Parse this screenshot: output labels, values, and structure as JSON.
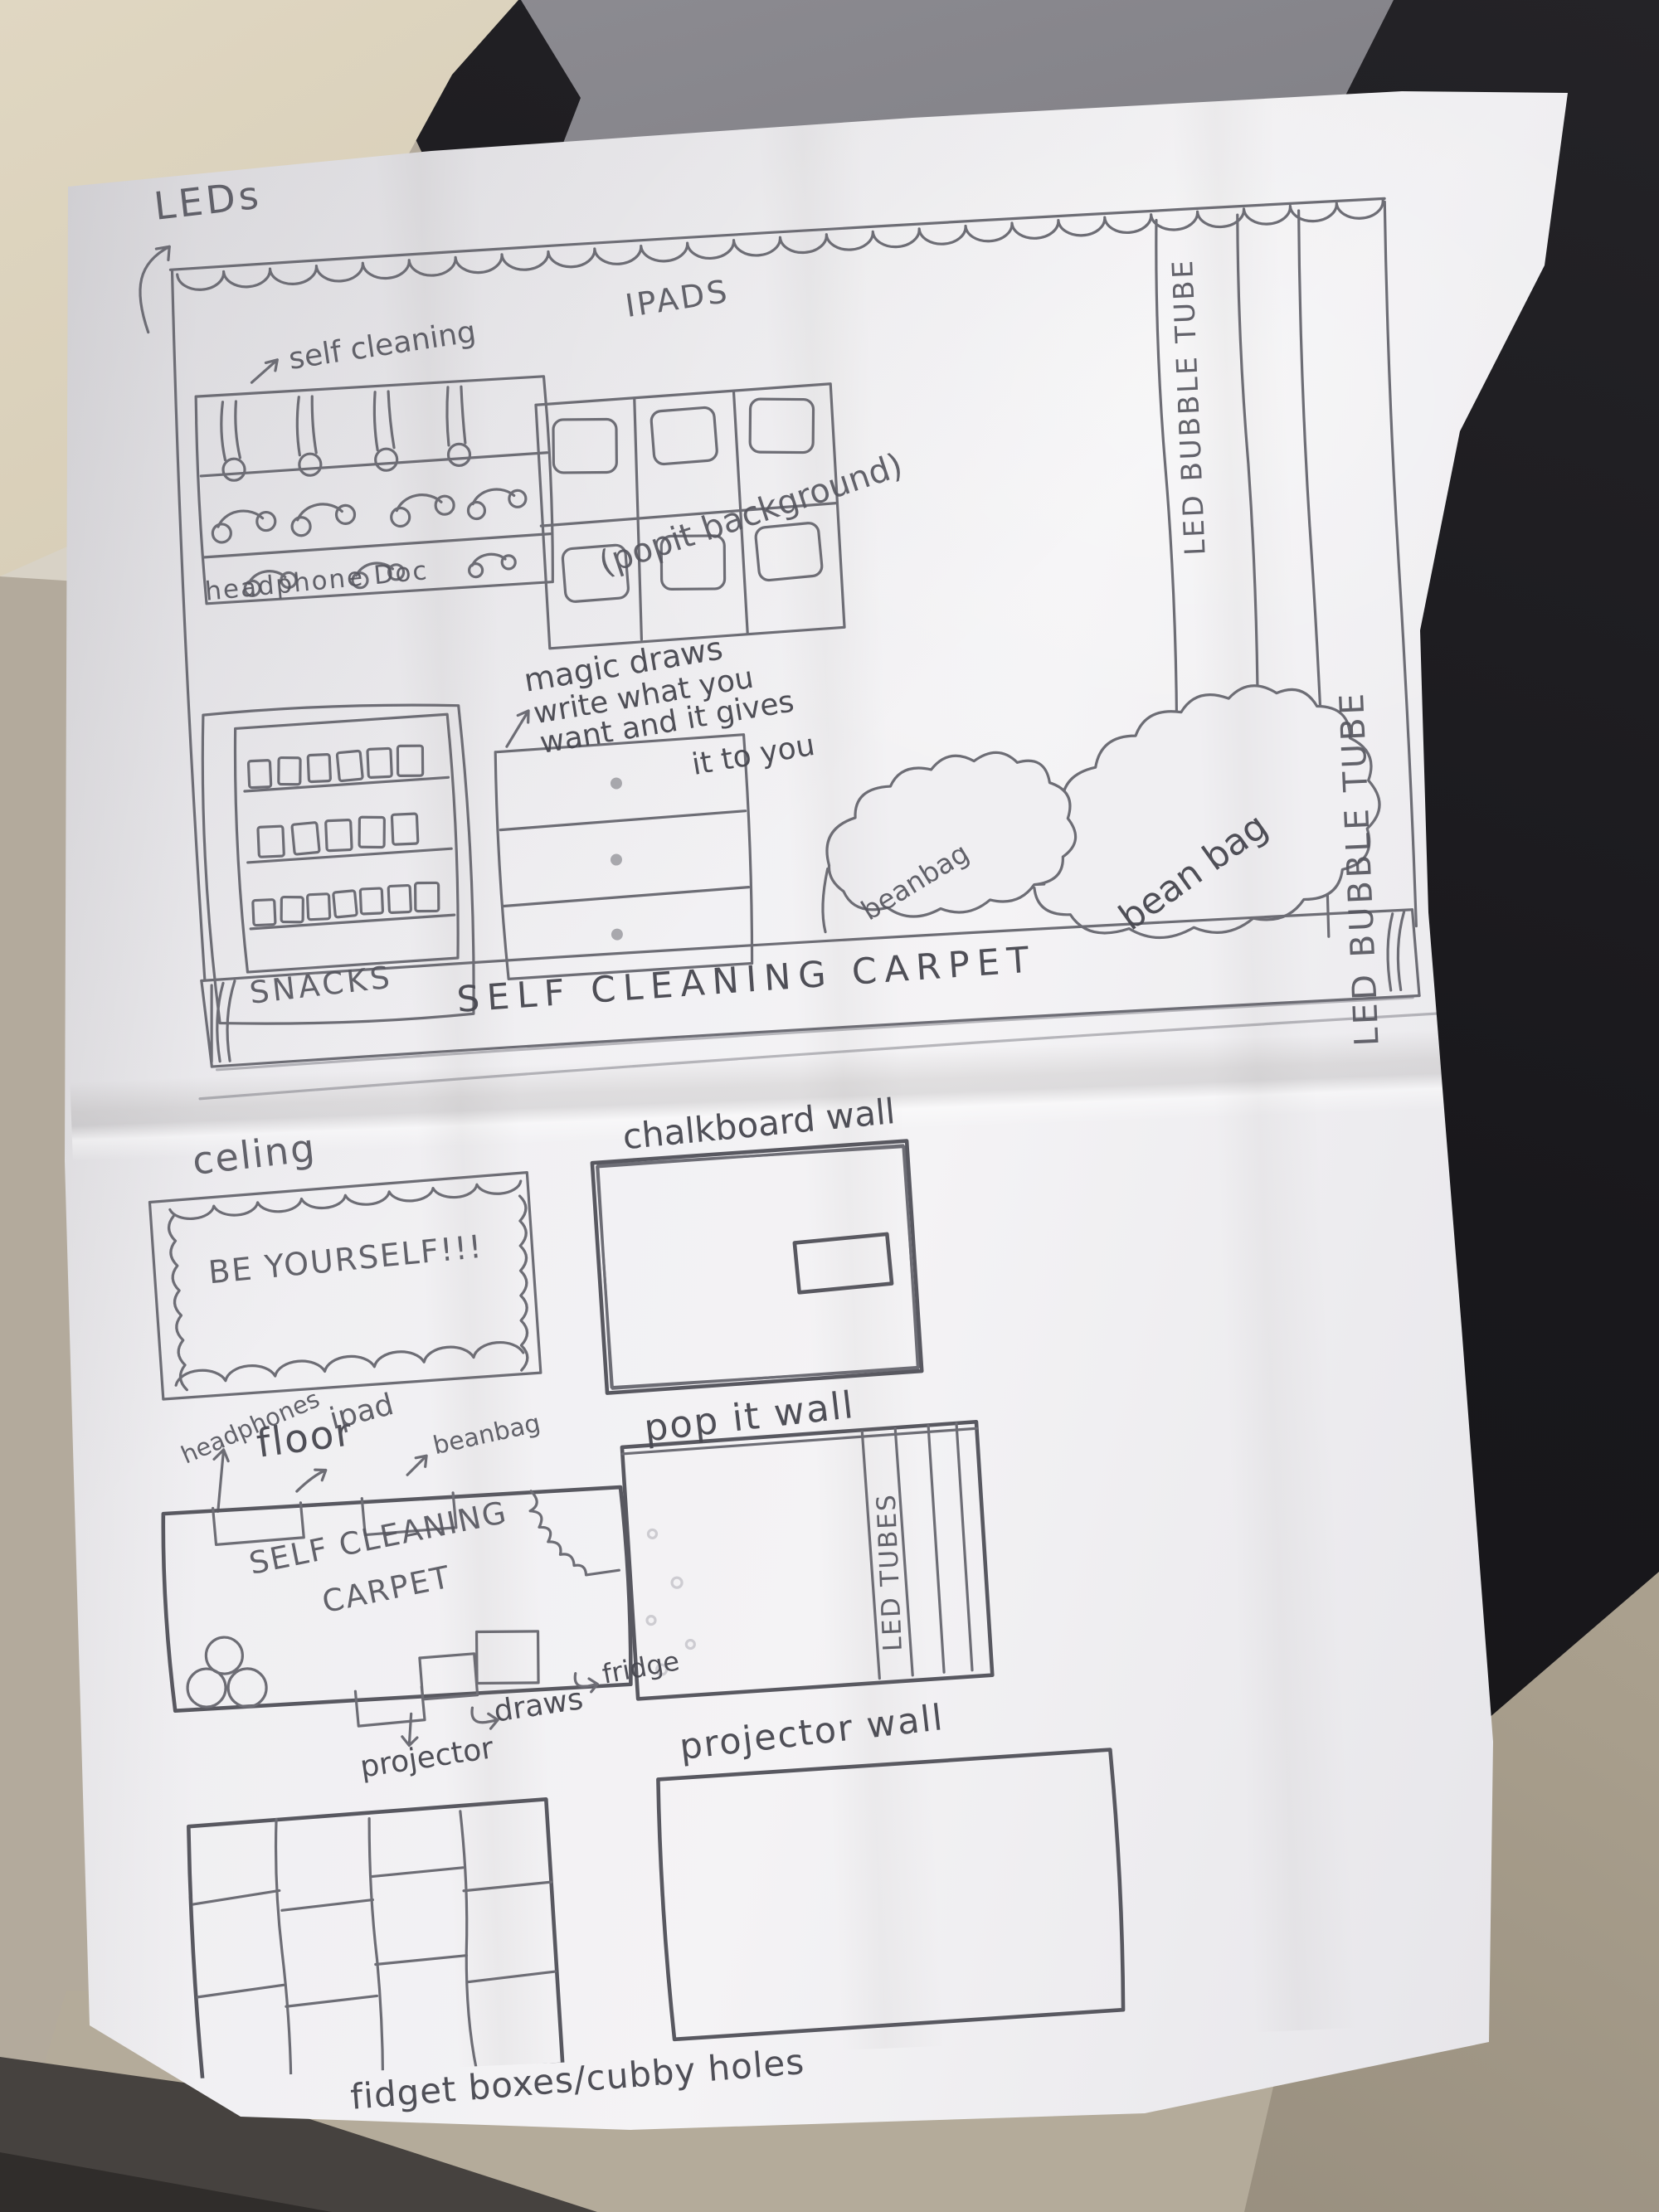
{
  "top": {
    "leds": "LEDs",
    "self_cleaning": "self cleaning",
    "headphone_dock": "headphone Doc",
    "ipads": "IPADS",
    "popit_note": "(popit background)",
    "bubble_tube": "LED BUBBLE TUBE",
    "bubble_tube2": "LED BUBBLE TUBE",
    "magic_line1": "magic draws",
    "magic_line2": "write what you",
    "magic_line3": "want and it gives",
    "magic_line4": "it to you",
    "beanbag_small": "beanbag",
    "beanbag_big": "bean bag",
    "snacks": "SNACKS",
    "carpet": "SELF CLEANING CARPET"
  },
  "bottom": {
    "ceiling": "celing",
    "sign": "BE YOURSELF!!!",
    "chalkboard": "chalkboard wall",
    "headphones": "headphones",
    "floor": "floor",
    "ipad": "ipad",
    "beanbag": "beanbag",
    "plan_line1": "SELF CLEANING",
    "plan_line2": "CARPET",
    "projector": "projector",
    "draws": "draws",
    "fridge": "fridge",
    "popit_wall": "pop it wall",
    "led_tubes": "LED TUBES",
    "projector_wall": "projector wall",
    "fidget": "fidget boxes/cubby holes"
  },
  "colors": {
    "pencil": "#6d6d75",
    "pencil_dark": "#585860",
    "paper": "#f0eff2"
  }
}
